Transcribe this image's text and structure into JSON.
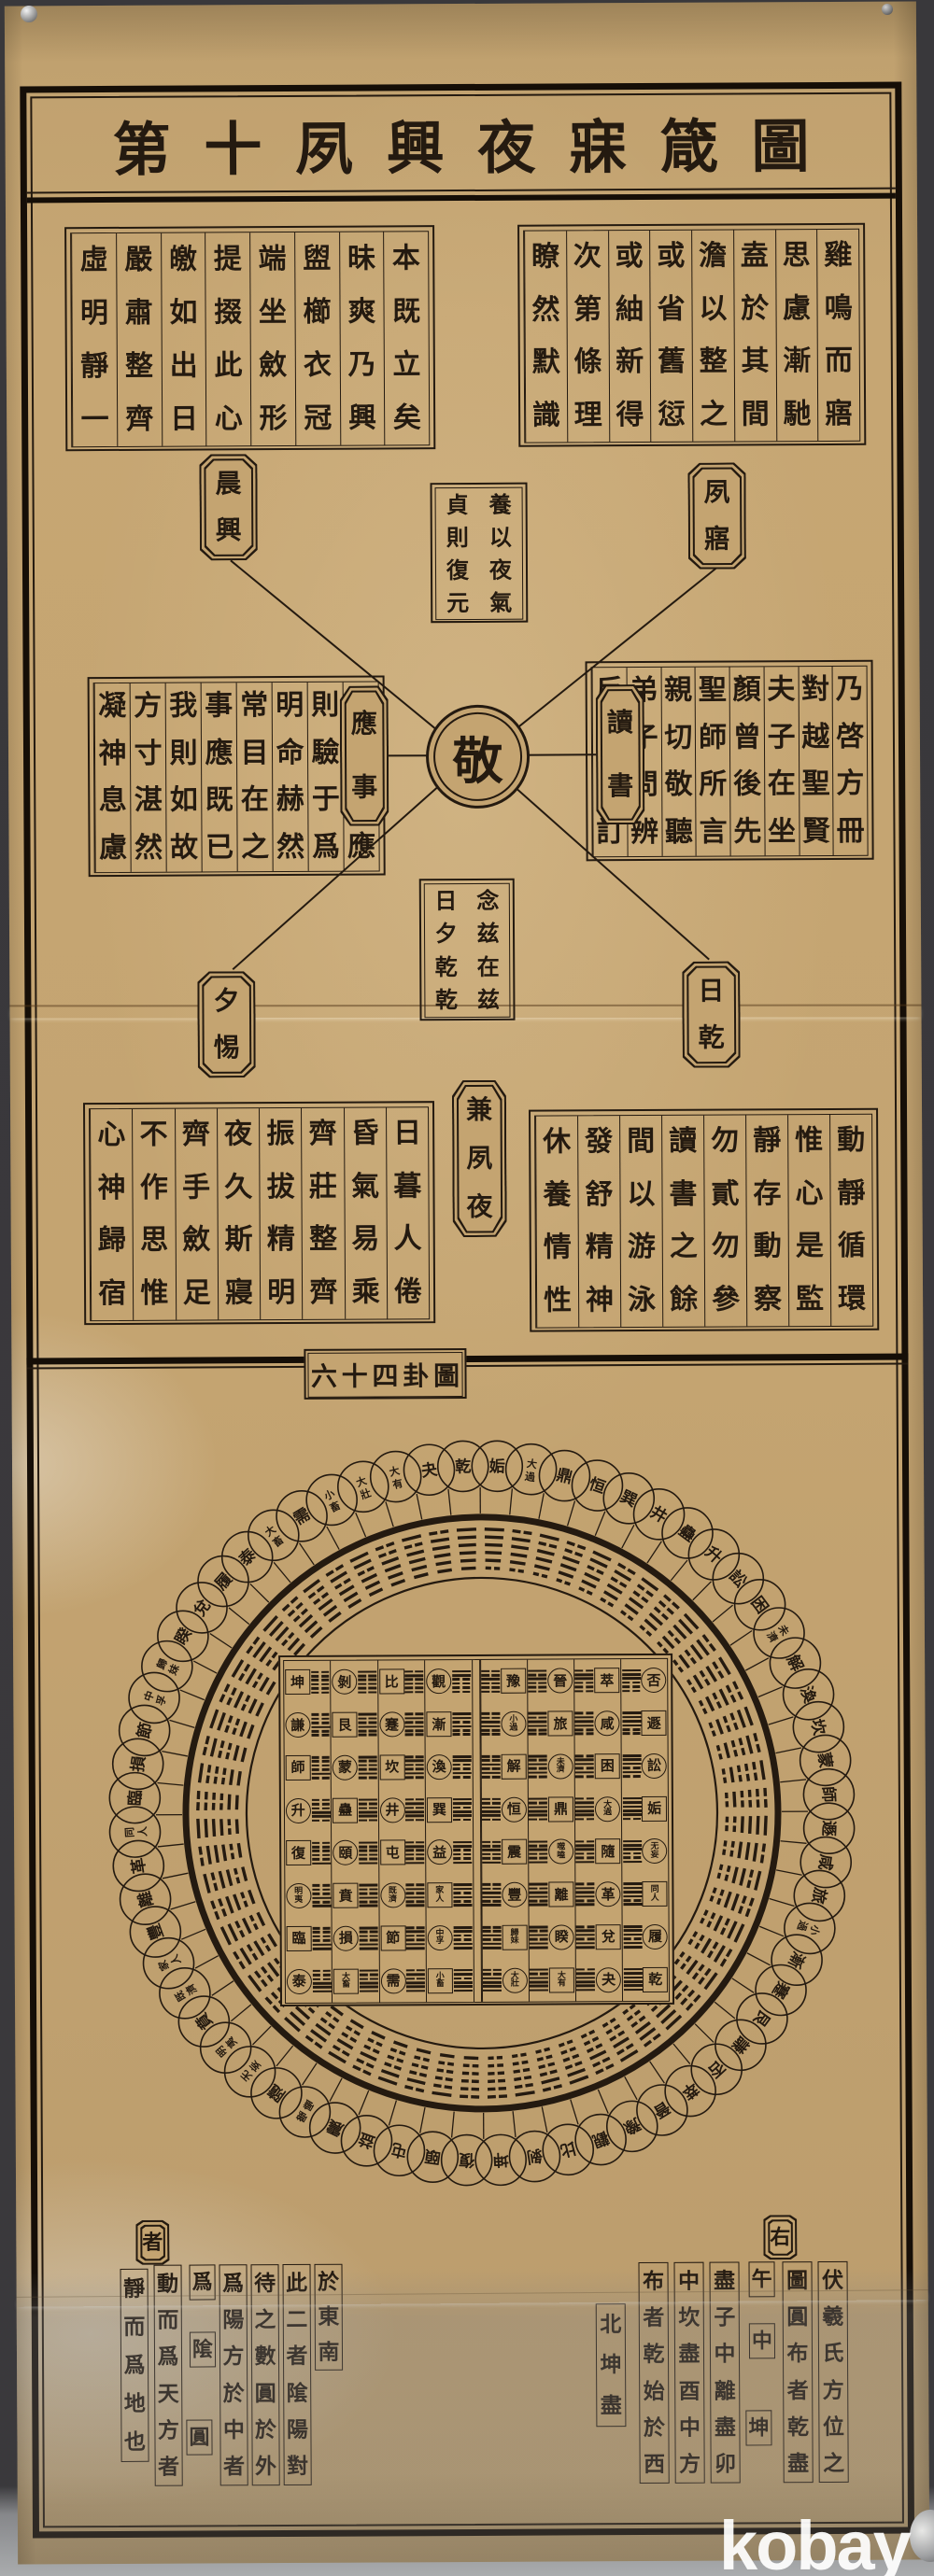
{
  "meta": {
    "artifact": "photograph of an antique printed Chinese scroll chart pinned to a board",
    "watermark": "kobay"
  },
  "title": {
    "text": "第十夙興夜寐箴圖",
    "reading": "right-to-left seal script"
  },
  "jamin": {
    "blocks": {
      "top_right": {
        "columns": [
          "雞鳴而寤",
          "思慮漸馳",
          "盍於其間",
          "澹以整之",
          "或省舊愆",
          "或紬新得",
          "次第條理",
          "瞭然默識"
        ]
      },
      "top_left": {
        "columns": [
          "本既立矣",
          "昧爽乃興",
          "盥櫛衣冠",
          "端坐斂形",
          "提掇此心",
          "皦如出日",
          "嚴肅整齊",
          "虛明靜一"
        ]
      },
      "mid_right": {
        "columns": [
          "乃啓方冊",
          "對越聖賢",
          "夫子在坐",
          "顏曾後先",
          "聖師所言",
          "親切敬聽",
          "弟子問辨",
          "反覆參訂"
        ]
      },
      "mid_left": {
        "columns": [
          "事至斯應",
          "則驗于爲",
          "明命赫然",
          "常目在之",
          "事應既已",
          "我則如故",
          "方寸湛然",
          "凝神息慮"
        ]
      },
      "bottom_left": {
        "columns": [
          "日暮人倦",
          "昏氣易乘",
          "齊莊整齊",
          "振拔精明",
          "夜久斯寢",
          "齊手斂足",
          "不作思惟",
          "心神歸宿"
        ]
      },
      "bottom_right": {
        "columns": [
          "動靜循環",
          "惟心是監",
          "靜存動察",
          "勿貳勿參",
          "讀書之餘",
          "間以游泳",
          "發舒精神",
          "休養情性"
        ]
      }
    },
    "tablets": {
      "top_left": "晨興",
      "top_right": "夙寤",
      "mid_left": "應事",
      "mid_right": "讀書",
      "bottom_left": "夕惕",
      "bottom_right": "日乾",
      "bottom_center": "兼夙夜"
    },
    "center_circle": "敬",
    "upper_box_columns": [
      "養以夜氣",
      "貞則復元"
    ],
    "lower_box_columns": [
      "念兹在兹",
      "日夕乾乾"
    ]
  },
  "chart_data": {
    "type": "diagram-64-hexagrams",
    "title": "六十四卦圖",
    "outer_ring_left_half_top_to_bottom": [
      "乾",
      "夬",
      "大有",
      "大壯",
      "小畜",
      "需",
      "大畜",
      "泰",
      "履",
      "兌",
      "睽",
      "歸妹",
      "中孚",
      "節",
      "損",
      "臨",
      "同人",
      "革",
      "離",
      "豐",
      "家人",
      "既濟",
      "賁",
      "明夷",
      "无妄",
      "隨",
      "噬嗑",
      "震",
      "益",
      "屯",
      "頤",
      "復"
    ],
    "outer_ring_right_half_top_to_bottom": [
      "姤",
      "大過",
      "鼎",
      "恒",
      "巽",
      "井",
      "蠱",
      "升",
      "訟",
      "困",
      "未濟",
      "解",
      "渙",
      "坎",
      "蒙",
      "師",
      "遯",
      "咸",
      "旅",
      "小過",
      "漸",
      "蹇",
      "艮",
      "謙",
      "否",
      "萃",
      "晉",
      "豫",
      "觀",
      "比",
      "剝",
      "坤"
    ],
    "square_rows_top_to_bottom_left_to_right": [
      [
        "坤",
        "剝",
        "比",
        "觀",
        "豫",
        "晉",
        "萃",
        "否"
      ],
      [
        "謙",
        "艮",
        "蹇",
        "漸",
        "小過",
        "旅",
        "咸",
        "遯"
      ],
      [
        "師",
        "蒙",
        "坎",
        "渙",
        "解",
        "未濟",
        "困",
        "訟"
      ],
      [
        "升",
        "蠱",
        "井",
        "巽",
        "恒",
        "鼎",
        "大過",
        "姤"
      ],
      [
        "復",
        "頤",
        "屯",
        "益",
        "震",
        "噬嗑",
        "隨",
        "无妄"
      ],
      [
        "明夷",
        "賁",
        "既濟",
        "家人",
        "豐",
        "離",
        "革",
        "同人"
      ],
      [
        "臨",
        "損",
        "節",
        "中孚",
        "歸妹",
        "睽",
        "兌",
        "履"
      ],
      [
        "泰",
        "大畜",
        "需",
        "小畜",
        "大壯",
        "大有",
        "夬",
        "乾"
      ]
    ],
    "square_lower_trigram_by_row_top_to_bottom": [
      "坤",
      "艮",
      "坎",
      "巽",
      "震",
      "離",
      "兌",
      "乾"
    ],
    "square_upper_trigram_by_col_left_to_right": [
      "坤",
      "艮",
      "坎",
      "巽",
      "震",
      "離",
      "兌",
      "乾"
    ],
    "trigram_lines_bottom_to_top": {
      "乾": "111",
      "兌": "110",
      "離": "101",
      "震": "100",
      "巽": "011",
      "坎": "010",
      "艮": "001",
      "坤": "000"
    }
  },
  "bottom_annotation": {
    "right_group": {
      "header": "右",
      "columns": [
        "伏羲氏方位之",
        "圖圓布者乾盡",
        "午",
        "中",
        "坤",
        "盡子中離盡卯",
        "中坎盡酉中方",
        "布者乾始於西",
        "北坤盡"
      ]
    },
    "left_group": {
      "header": "者",
      "columns": [
        "於東南",
        "此二者隂陽對",
        "待之數圓於外",
        "爲陽方於中者",
        "爲",
        "隂",
        "圓",
        "動而爲天方者",
        "靜而爲地也"
      ]
    }
  },
  "colors": {
    "paper": "#c4a471",
    "ink": "#241a10",
    "frame": "#150e07",
    "backdrop": "#3a393c",
    "watermark": "#ffffff"
  }
}
